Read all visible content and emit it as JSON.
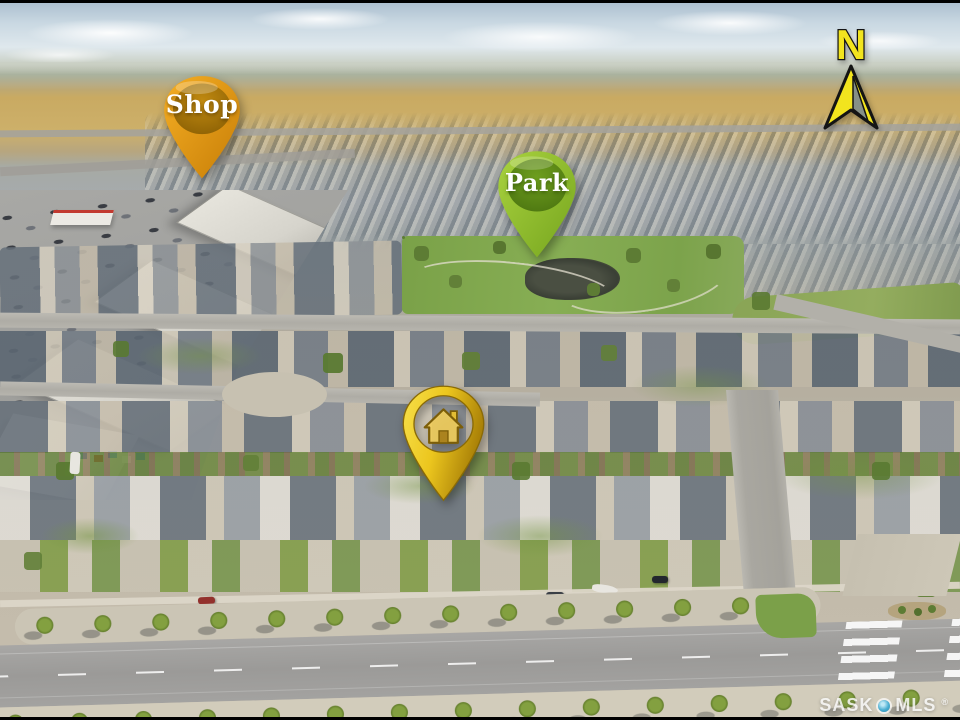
{
  "scene": {
    "alt": "Aerial drone photograph of a prairie suburban neighbourhood with a commercial area, a park, rows of houses and farmland on the horizon"
  },
  "markers": {
    "shop": {
      "label": "Shop",
      "outer_color": "#E8991B",
      "inner_color": "#9A6B06"
    },
    "park": {
      "label": "Park",
      "outer_color": "#97C236",
      "inner_color": "#5D8B16"
    },
    "home": {
      "icon": "house",
      "outer_color": "#EDD028",
      "inner_color": "#B8860B"
    }
  },
  "compass": {
    "label": "N",
    "arrow_color": "#F2E41E"
  },
  "watermark": {
    "left": "SASK",
    "right": "MLS",
    "registered": "®",
    "dot_color": "#49AED2"
  }
}
